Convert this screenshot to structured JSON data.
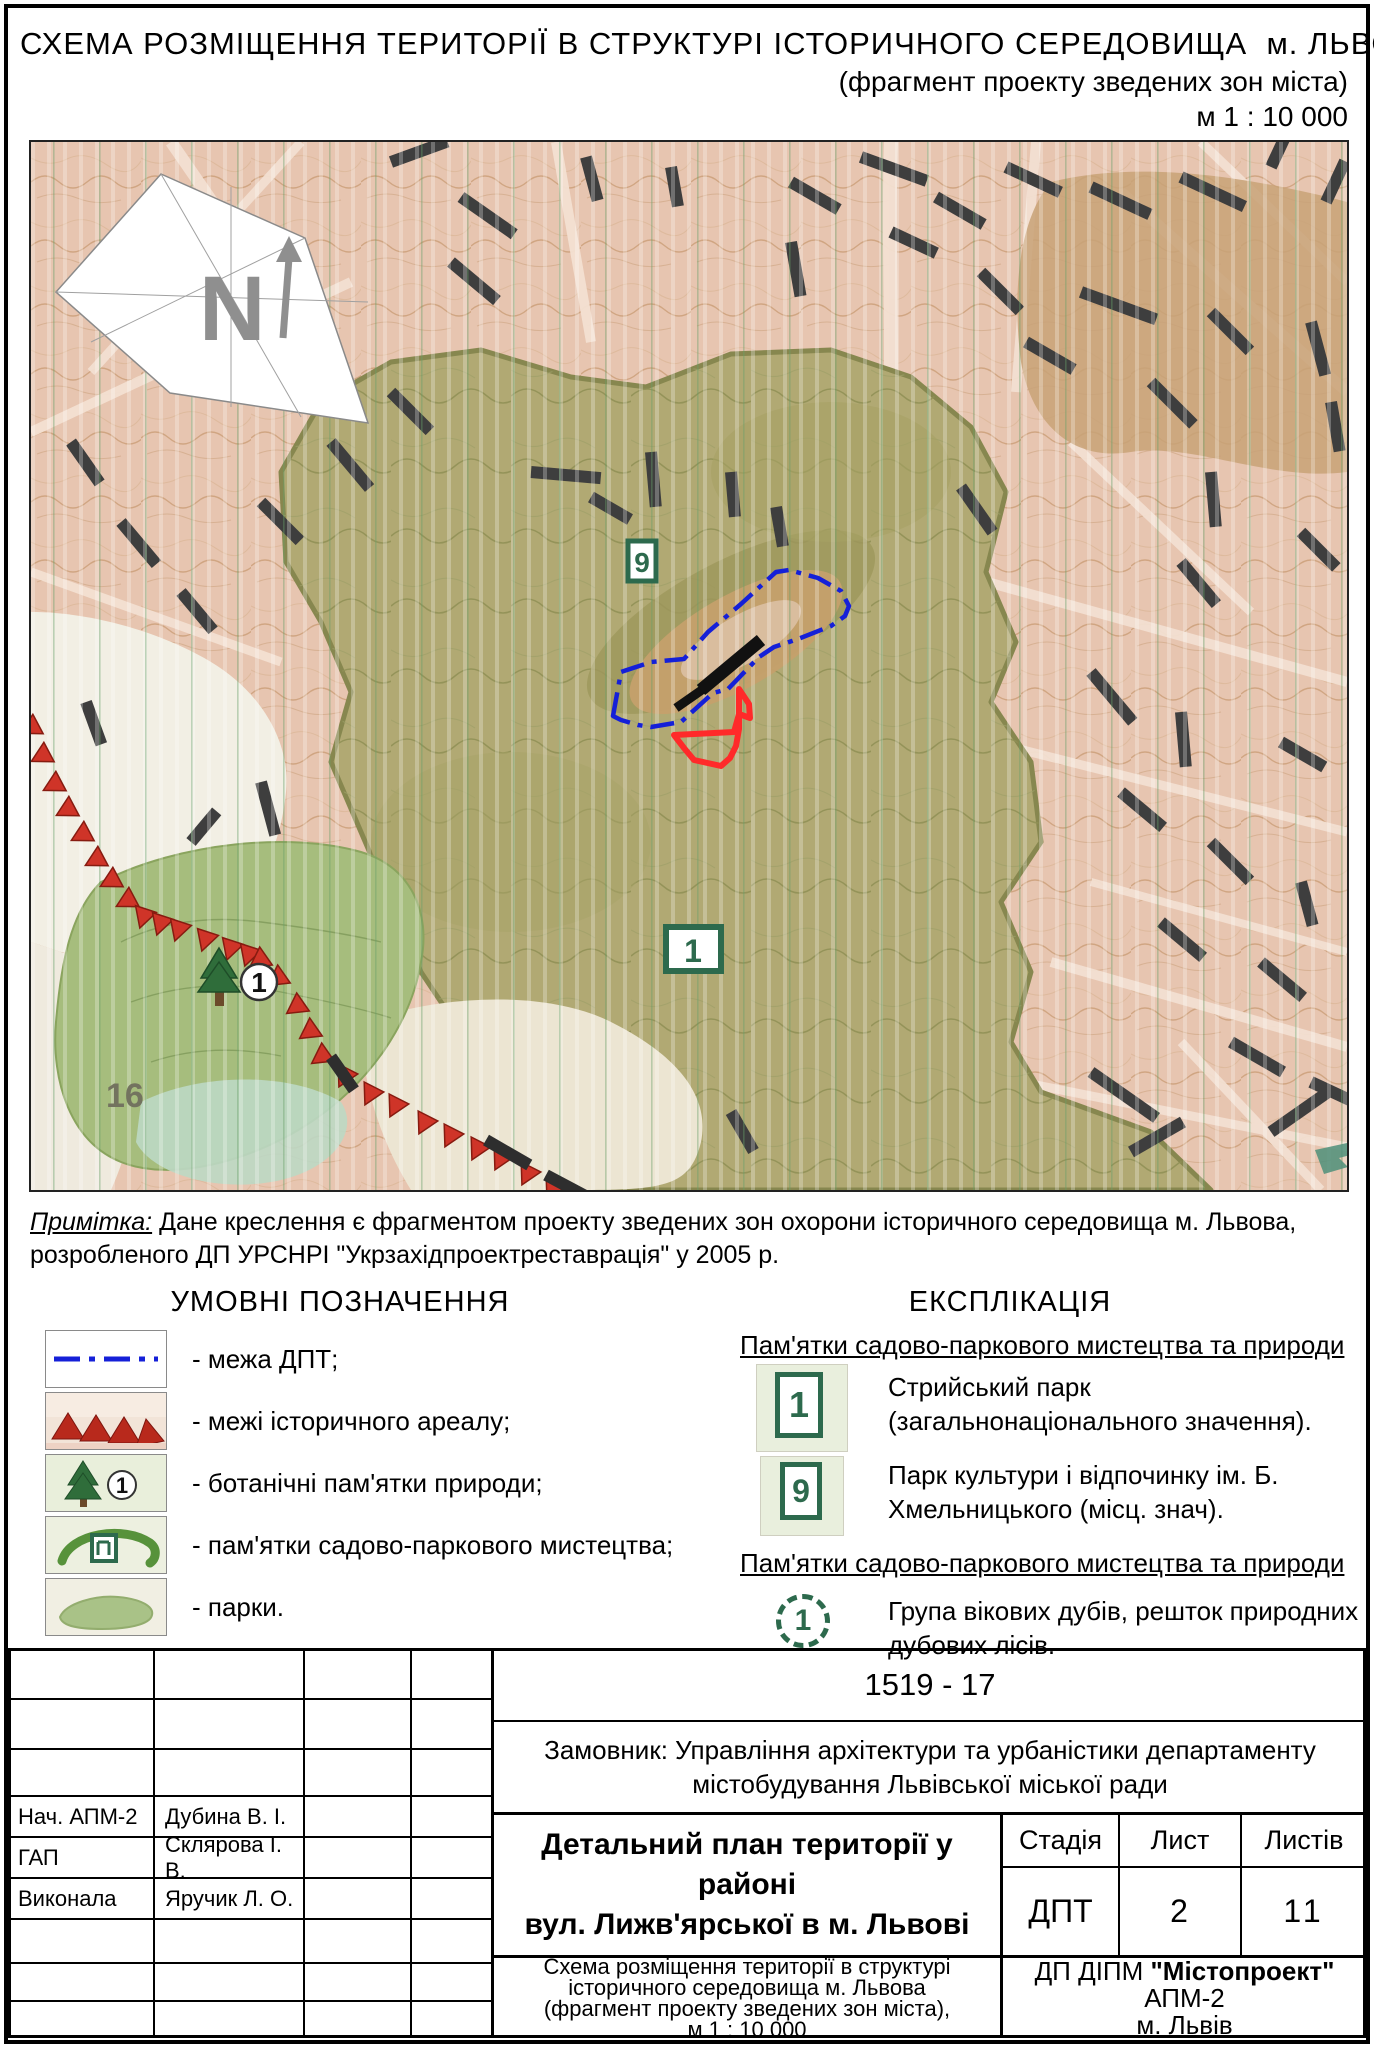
{
  "header": {
    "title_line1": "СХЕМА РОЗМІЩЕННЯ ТЕРИТОРІЇ В СТРУКТУРІ ІСТОРИЧНОГО СЕРЕДОВИЩА  м. ЛЬВОВА",
    "title_line2": "(фрагмент проекту зведених зон міста)",
    "scale": "м 1 : 10 000"
  },
  "map": {
    "north_label": "N",
    "labels": {
      "area16": "16",
      "park1": "1",
      "park9": "9",
      "botanical1": "1"
    },
    "colors": {
      "dpt_boundary": "#1520d8",
      "site_outline": "#ff2a2a",
      "historic_areal": "#cf3428",
      "park_symbol": "#2d6a4d"
    }
  },
  "note": {
    "label": "Примітка:",
    "line1": "Дане креслення є фрагментом проекту зведених зон охорони історичного середовища м. Львова,",
    "line2": "розробленого ДП УРСНРІ \"Укрзахідпроектреставрація\" у 2005 р."
  },
  "legend": {
    "title": "УМОВНІ ПОЗНАЧЕННЯ",
    "items": [
      {
        "label": "- межа ДПТ;"
      },
      {
        "label": "- межі історичного ареалу;"
      },
      {
        "label": "- ботанічні пам'ятки природи;",
        "symbol": "1"
      },
      {
        "label": "- пам'ятки садово-паркового мистецтва;"
      },
      {
        "label": "- парки."
      }
    ]
  },
  "explication": {
    "title": "ЕКСПЛІКАЦІЯ",
    "section1_title": "Пам'ятки садово-паркового мистецтва та природи",
    "item1_symbol": "1",
    "item1_text": "Стрийський парк (загальнонаціонального значення).",
    "item2_symbol": "9",
    "item2_text": "Парк культури і відпочинку ім. Б. Хмельницького (місц. знач).",
    "section2_title": "Пам'ятки садово-паркового мистецтва та природи",
    "item3_symbol": "1",
    "item3_text": "Група вікових дубів, решток природних дубових лісів."
  },
  "title_block": {
    "project_number": "1519 - 17",
    "client_line1": "Замовник: Управління архітектури та урбаністики департаменту",
    "client_line2": "містобудування Львівської міської ради",
    "project_title_line1": "Детальний план території у районі",
    "project_title_line2": "вул. Лижв'ярської в м. Львові",
    "stage_label": "Стадія",
    "sheet_label": "Лист",
    "sheets_label": "Листів",
    "stage_value": "ДПТ",
    "sheet_value": "2",
    "sheets_value": "11",
    "drawing_title_line1": "Схема розміщення території в структурі",
    "drawing_title_line2": "історичного середовища м. Львова",
    "drawing_title_line3": "(фрагмент проекту зведених зон міста),",
    "drawing_title_line4": "м 1 : 10 000",
    "org_prefix": "ДП ДІПМ ",
    "org_name": "\"Містопроект\"",
    "org_line2": "АПМ-2",
    "org_line3": "м. Львів",
    "signers": [
      {
        "role": "Нач. АПМ-2",
        "name": "Дубина В. І."
      },
      {
        "role": "ГАП",
        "name": "Склярова І. В."
      },
      {
        "role": "Виконала",
        "name": "Яручик Л. О."
      }
    ]
  }
}
